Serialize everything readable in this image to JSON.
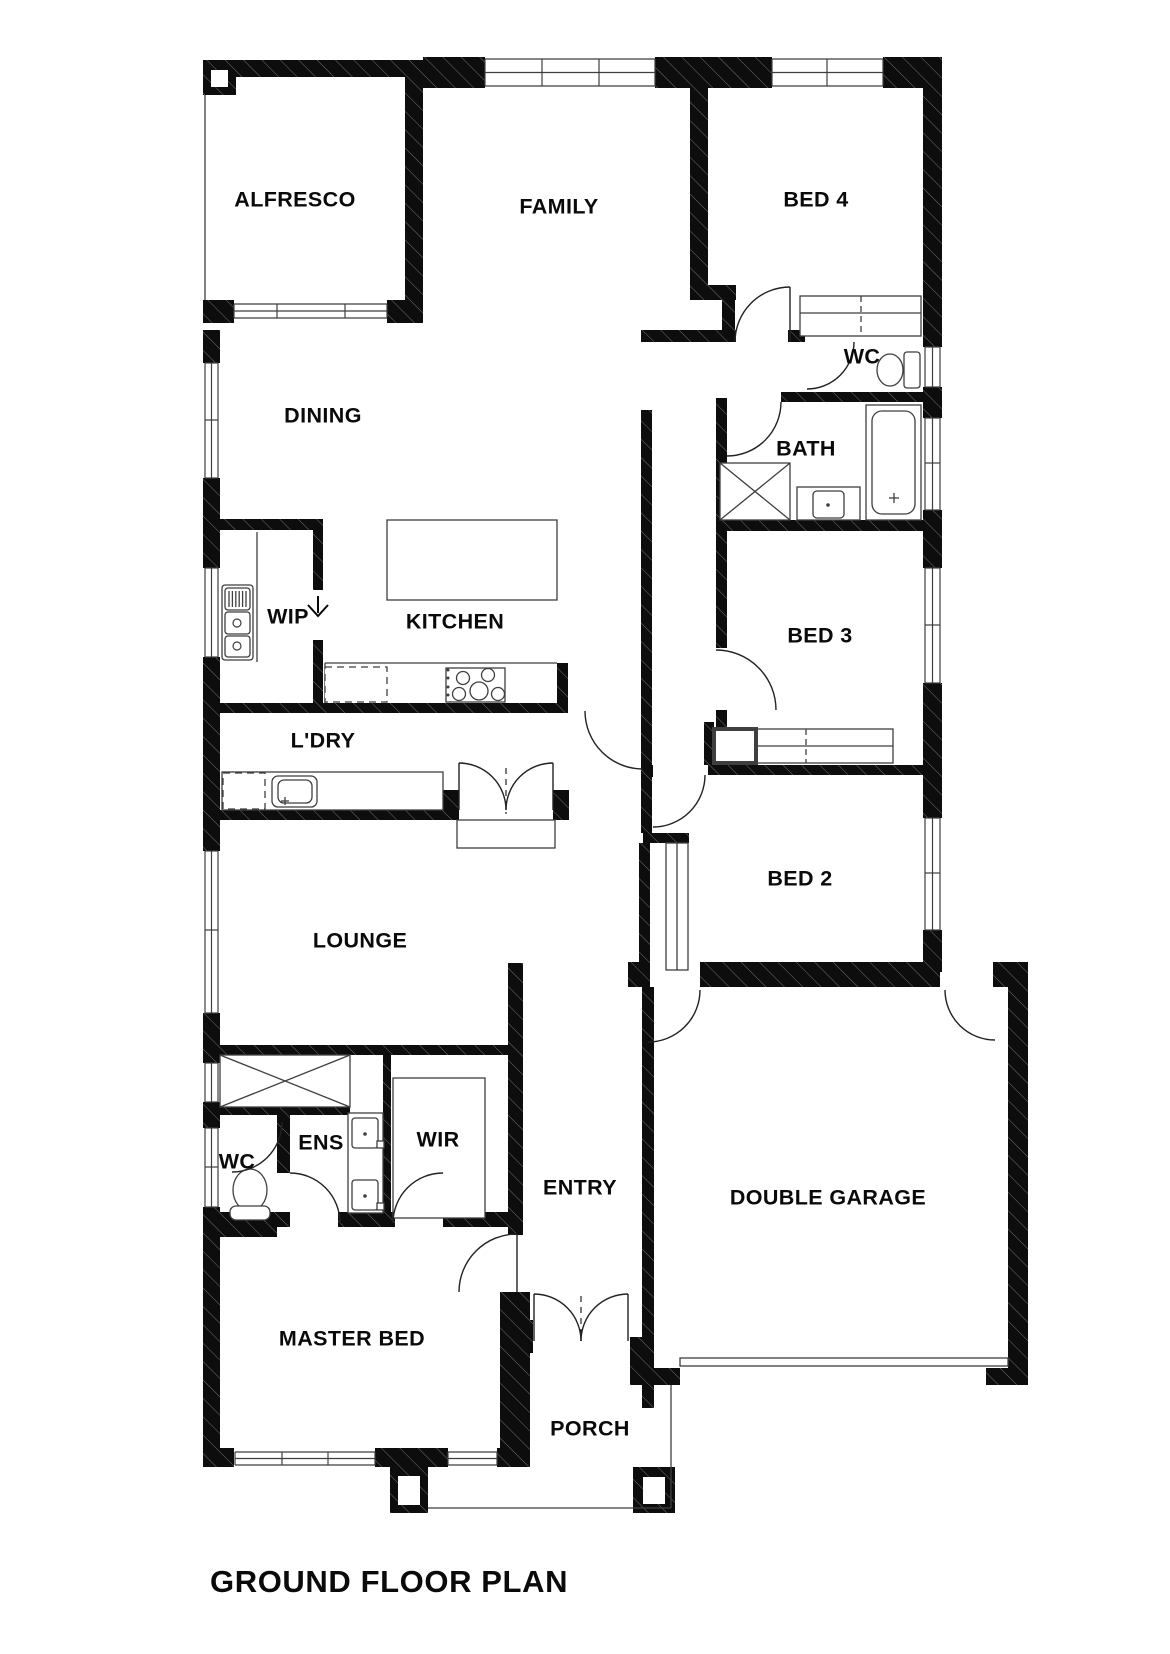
{
  "title": {
    "text": "GROUND FLOOR PLAN"
  },
  "rooms": {
    "alfresco": {
      "label": "ALFRESCO"
    },
    "family": {
      "label": "FAMILY"
    },
    "bed4": {
      "label": "BED 4"
    },
    "wc_upper": {
      "label": "WC"
    },
    "dining": {
      "label": "DINING"
    },
    "bath": {
      "label": "BATH"
    },
    "bed3": {
      "label": "BED 3"
    },
    "wip": {
      "label": "WIP"
    },
    "kitchen": {
      "label": "KITCHEN"
    },
    "ldry": {
      "label": "L'DRY"
    },
    "bed2": {
      "label": "BED 2"
    },
    "lounge": {
      "label": "LOUNGE"
    },
    "ens": {
      "label": "ENS"
    },
    "wir": {
      "label": "WIR"
    },
    "wc_lower": {
      "label": "WC"
    },
    "entry": {
      "label": "ENTRY"
    },
    "garage": {
      "label": "DOUBLE GARAGE"
    },
    "master": {
      "label": "MASTER BED"
    },
    "porch": {
      "label": "PORCH"
    }
  },
  "colors": {
    "wall": "#0d0d0d",
    "line": "#3f3f3f",
    "background": "#ffffff"
  }
}
